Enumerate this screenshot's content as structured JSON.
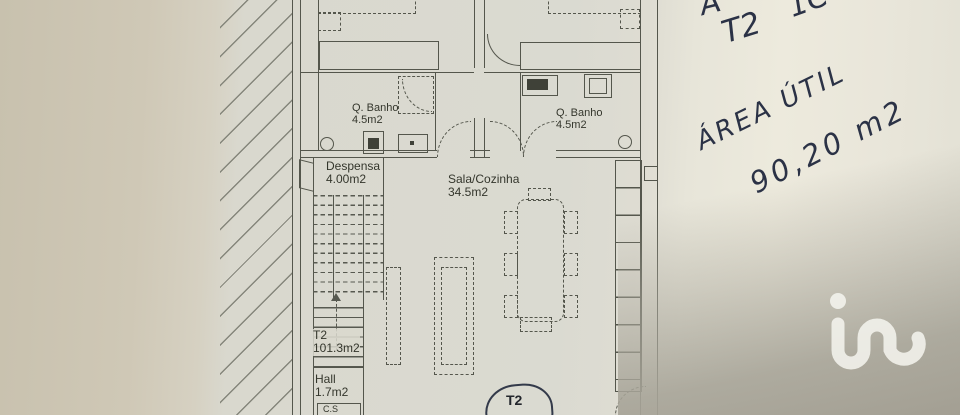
{
  "plan": {
    "rooms": {
      "bath_left": {
        "name": "Q. Banho",
        "area": "4.5m2"
      },
      "bath_right": {
        "name": "Q. Banho",
        "area": "4.5m2"
      },
      "pantry": {
        "name": "Despensa",
        "area": "4.00m2"
      },
      "living_kitchen": {
        "name": "Sala/Cozinha",
        "area": "34.5m2"
      },
      "unit": {
        "name": "T2",
        "area": "101.3m2"
      },
      "hall": {
        "name": "Hall",
        "area": "1.7m2"
      },
      "wc_small": {
        "name": "C.S"
      }
    },
    "unit_marker": "T2"
  },
  "handwriting": {
    "fragment_left": "A",
    "fragment_right": "1C",
    "unit": "T2",
    "area_label": "ÁREA ÚTIL",
    "area_value": "90,20 m2"
  },
  "watermark": {
    "brand": "iad"
  },
  "colors": {
    "plan_line": "#54564c",
    "ink": "#2b3246",
    "paper": "#d9d9d0",
    "paper_left": "#cdc6b4",
    "shade_gray": "#a9a79b"
  }
}
